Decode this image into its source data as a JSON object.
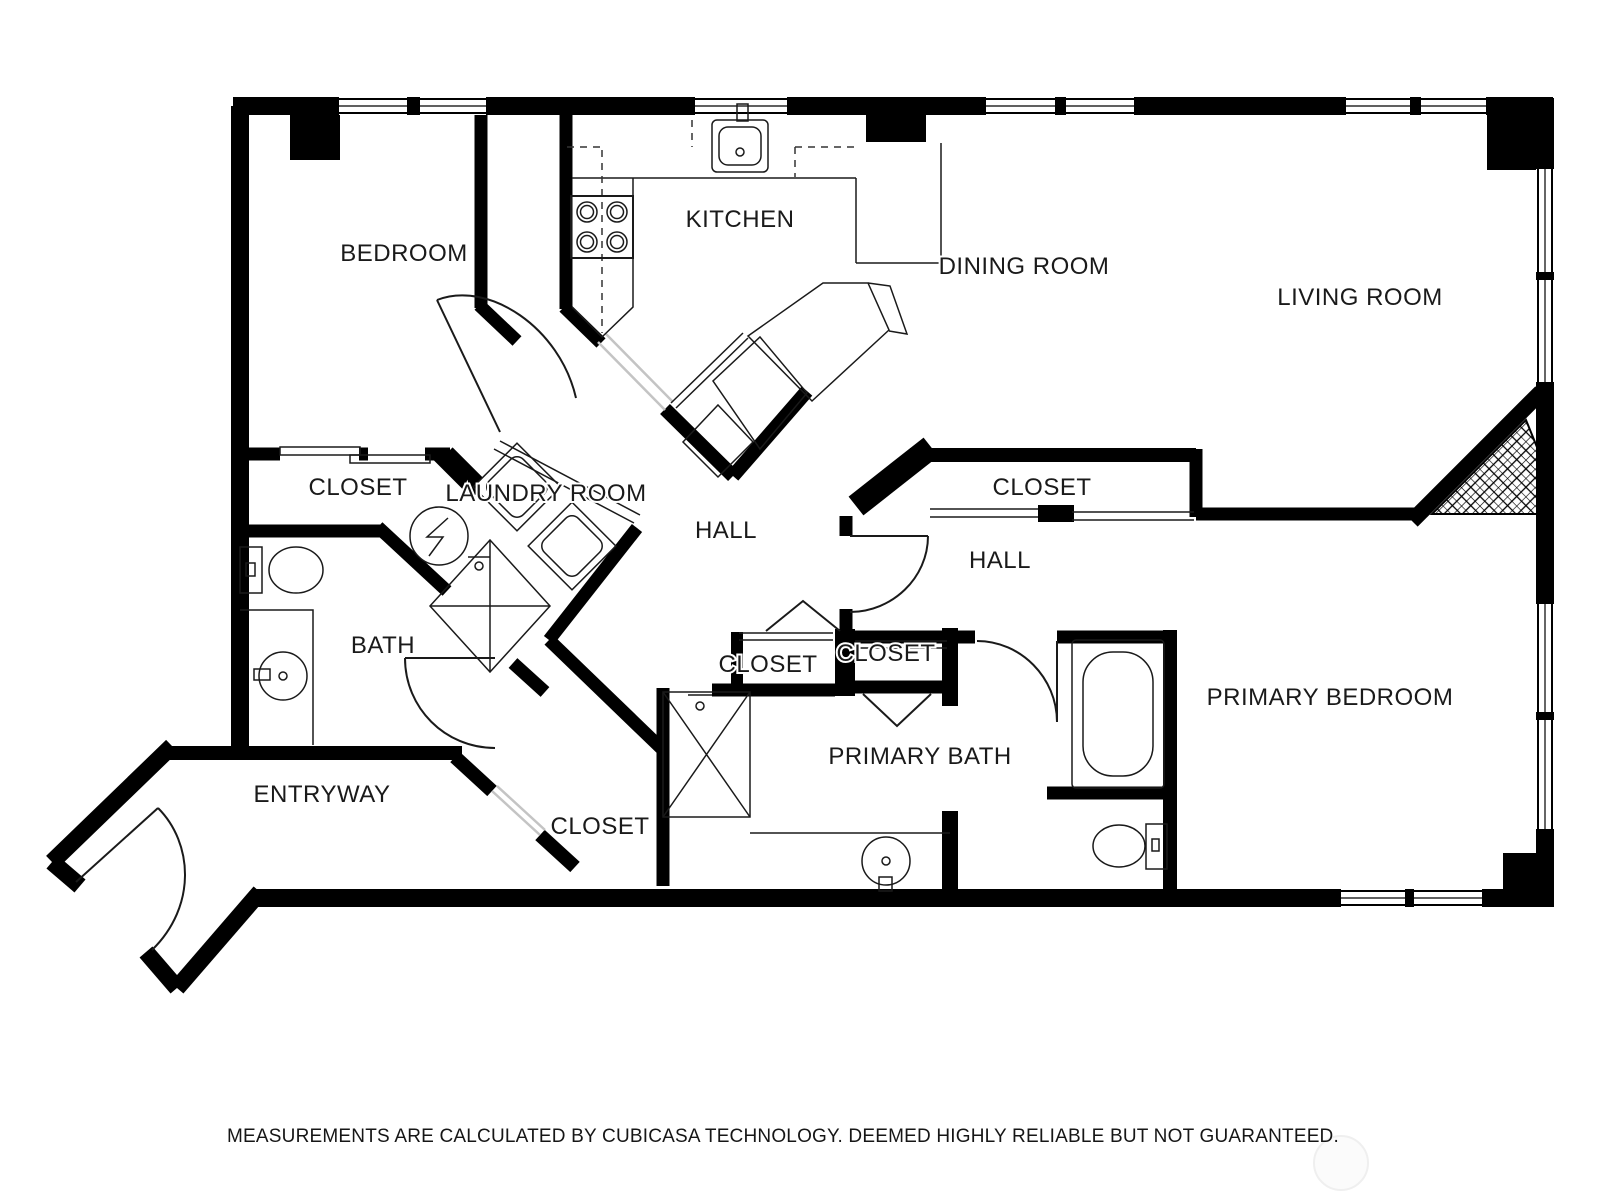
{
  "plan": {
    "title": "apartment-floor-plan",
    "rooms": [
      {
        "id": "bedroom",
        "label": "BEDROOM"
      },
      {
        "id": "kitchen",
        "label": "KITCHEN"
      },
      {
        "id": "dining-room",
        "label": "DINING ROOM"
      },
      {
        "id": "living-room",
        "label": "LIVING ROOM"
      },
      {
        "id": "closet-bedroom",
        "label": "CLOSET"
      },
      {
        "id": "laundry-room",
        "label": "LAUNDRY ROOM"
      },
      {
        "id": "hall-center",
        "label": "HALL"
      },
      {
        "id": "closet-hall",
        "label": "CLOSET"
      },
      {
        "id": "hall-right",
        "label": "HALL"
      },
      {
        "id": "bath",
        "label": "BATH"
      },
      {
        "id": "closet-small-left",
        "label": "CLOSET"
      },
      {
        "id": "closet-small-right",
        "label": "CLOSET"
      },
      {
        "id": "primary-bedroom",
        "label": "PRIMARY BEDROOM"
      },
      {
        "id": "primary-bath",
        "label": "PRIMARY BATH"
      },
      {
        "id": "entryway",
        "label": "ENTRYWAY"
      },
      {
        "id": "closet-entry",
        "label": "CLOSET"
      }
    ],
    "footer": "MEASUREMENTS ARE CALCULATED BY CUBICASA TECHNOLOGY. DEEMED HIGHLY RELIABLE BUT NOT GUARANTEED.",
    "fixtures": [
      "stove-burners-icon",
      "kitchen-sink-icon",
      "washer-icon",
      "dryer-icon",
      "water-heater-icon",
      "toilet-icon",
      "bathroom-sink-icon",
      "bathtub-icon",
      "shower-icon",
      "fireplace-hatch-icon",
      "door-swing-icon",
      "sliding-door-icon",
      "bifold-door-icon",
      "window-icon",
      "entry-door-icon",
      "dining-furniture-icon"
    ],
    "colors": {
      "wall": "#000000",
      "label": "#1a1a1a",
      "opening": "#c4c4c4",
      "background": "#ffffff",
      "watermark": "#efefef"
    }
  }
}
